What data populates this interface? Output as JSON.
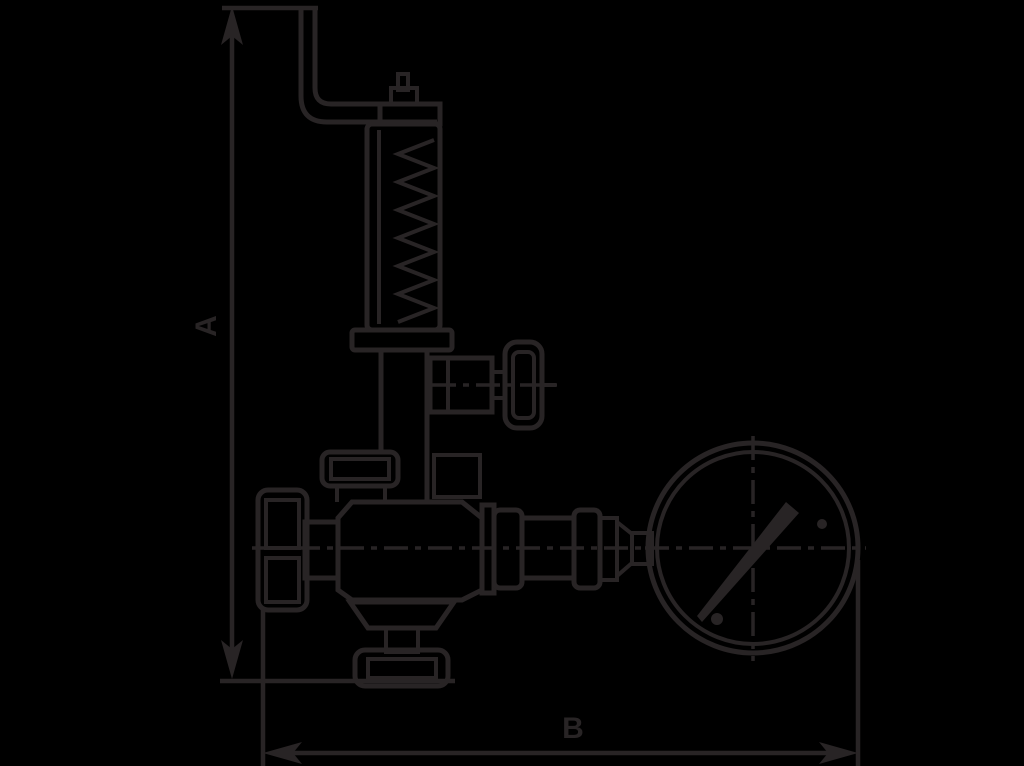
{
  "meta": {
    "width": 1024,
    "height": 766,
    "background_color": "#000000",
    "ink_color": "#282425",
    "description": "Black-background technical line drawing of a lever-type safety relief valve with spring bonnet, side handwheel port, adjustment knob, outlet flange and attached pressure gauge, annotated with overall height and width dimension arrows"
  },
  "dimensions": {
    "vertical": {
      "label": "A",
      "meaning": "overall height dimension"
    },
    "horizontal": {
      "label": "B",
      "meaning": "overall width dimension"
    }
  },
  "drawing": {
    "type": "technical-line-drawing",
    "parts": [
      "lever-arm",
      "top-stem",
      "spring-bonnet",
      "spring-coil",
      "bonnet-flange",
      "side-port",
      "side-handwheel",
      "chamber-flange",
      "adjustment-knob",
      "valve-body",
      "outlet-cone",
      "bottom-flange",
      "gauge-piping",
      "pressure-gauge",
      "gauge-needle"
    ]
  }
}
